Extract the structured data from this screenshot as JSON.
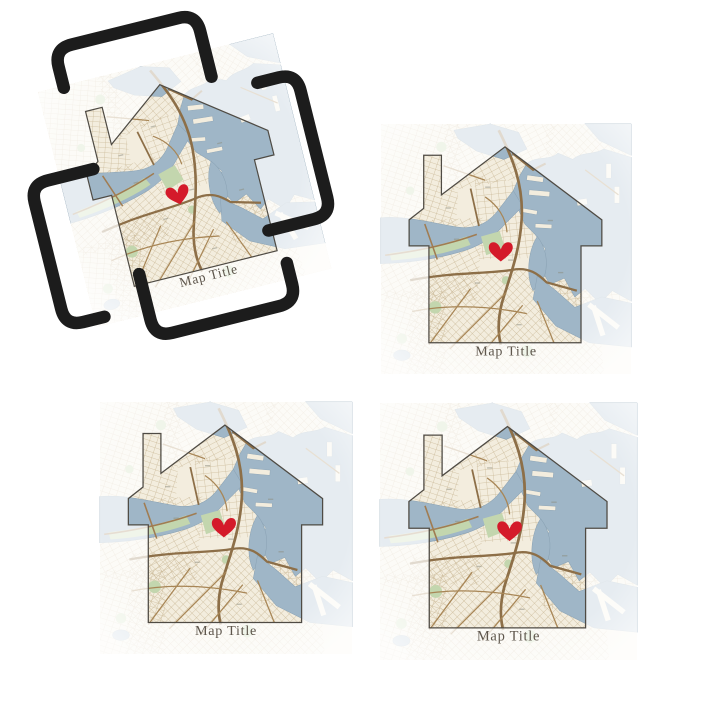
{
  "product": {
    "name": "house-map-coaster-set-with-holder",
    "coasters": [
      {
        "position": "in-holder",
        "title": "Map Title"
      },
      {
        "position": "top-right",
        "title": "Map Title"
      },
      {
        "position": "bottom-left",
        "title": "Map Title"
      },
      {
        "position": "bottom-right",
        "title": "Map Title"
      }
    ]
  },
  "icons": {
    "heart": "heart-location-marker"
  },
  "colors": {
    "background": "#ffffff",
    "heart": "#d41a2a",
    "title_text": "#5e564c",
    "house_outline": "#4f4b44",
    "map_land": "#f3edde",
    "map_water": "#9fb6c7",
    "map_park": "#c3d6ae",
    "map_road_major": "#8d6f48",
    "map_road_minor": "#c9b795",
    "holder_wire": "#1c1c1c"
  }
}
